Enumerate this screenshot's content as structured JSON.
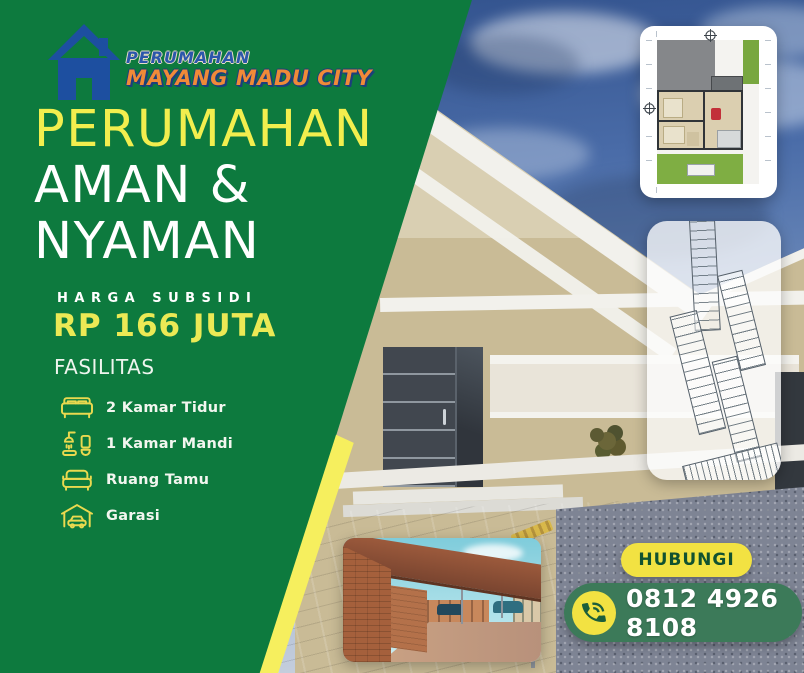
{
  "colors": {
    "panel_green": "#0d7a3e",
    "headline_yellow": "#f2ee4e",
    "price_yellow": "#ebe955",
    "accent_stripe_yellow": "#f6ef5e",
    "logo_blue": "#2b57ab",
    "logo_orange": "#f08a38",
    "hubungi_yellow": "#f2e242",
    "phone_pill_green": "#3c7a59",
    "facility_icon_yellow": "#ead94f"
  },
  "logo": {
    "icon": "house-icon",
    "line1": "PERUMAHAN",
    "line2": "MAYANG MADU CITY"
  },
  "headline": {
    "line1": "PERUMAHAN",
    "line2": "AMAN &",
    "line3": "NYAMAN"
  },
  "price": {
    "label": "HARGA SUBSIDI",
    "value": "RP 166 JUTA"
  },
  "facilities": {
    "title": "FASILITAS",
    "items": [
      {
        "icon": "bed-icon",
        "label": "2 Kamar Tidur"
      },
      {
        "icon": "bath-icon",
        "label": "1 Kamar Mandi"
      },
      {
        "icon": "sofa-icon",
        "label": "Ruang Tamu"
      },
      {
        "icon": "garage-icon",
        "label": "Garasi"
      }
    ]
  },
  "contact": {
    "button_label": "HUBUNGI",
    "phone_icon": "phone-icon",
    "phone_number": "0812 4926 8108"
  },
  "images": {
    "main_photo": "house-photo",
    "floor_plan": "floor-plan-thumbnail",
    "site_plan": "site-plan-thumbnail",
    "gate_photo": "entrance-gate-thumbnail"
  }
}
